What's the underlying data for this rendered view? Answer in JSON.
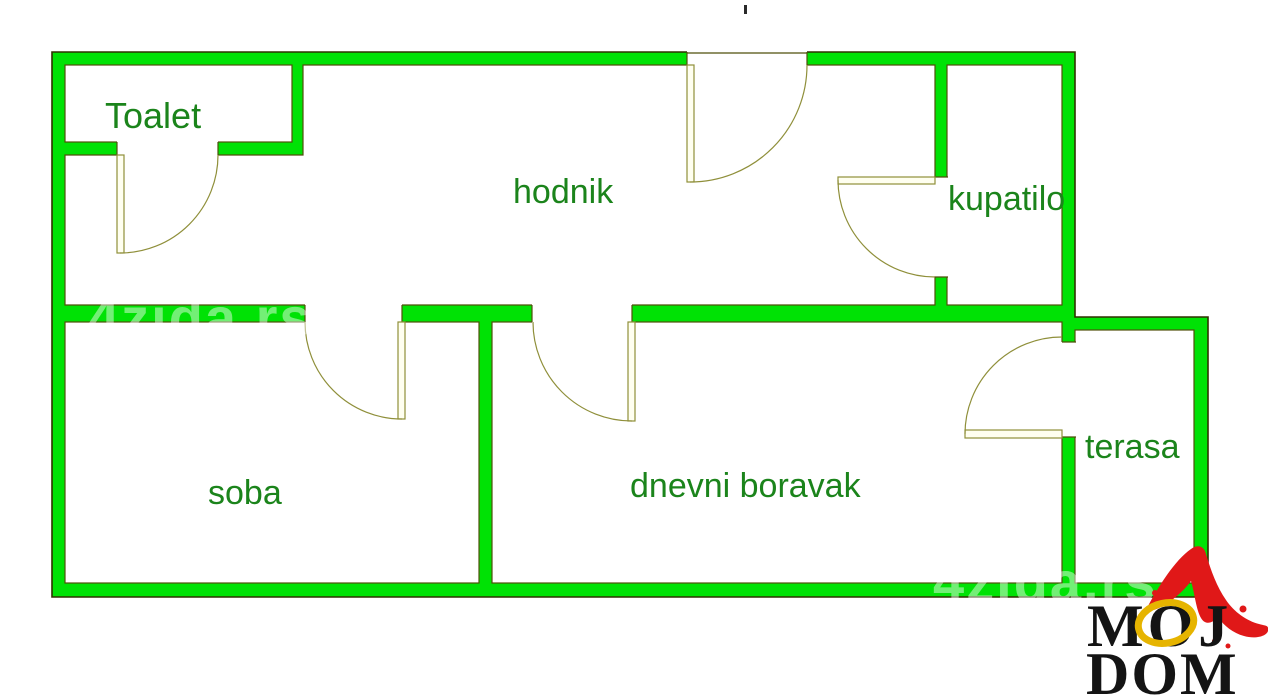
{
  "rooms": {
    "toalet": {
      "label": "Toalet"
    },
    "hodnik": {
      "label": "hodnik"
    },
    "kupatilo": {
      "label": "kupatilo"
    },
    "soba": {
      "label": "soba"
    },
    "dnevni_boravak": {
      "label": "dnevni boravak"
    },
    "terasa": {
      "label": "terasa"
    }
  },
  "watermark": {
    "text": "4zida.rs"
  },
  "logo": {
    "line1": "MOJ",
    "line2": "DOM"
  },
  "colors": {
    "wall-green": "#00e205",
    "outer-line": "#303000",
    "inner-line": "#4f4f0a",
    "arc-line": "#8f8f3a",
    "leaf-fill": "#fffff0",
    "label-green": "#1b841b",
    "logo-red": "#e01818",
    "logo-gold": "#e6b400",
    "logo-black": "#141414"
  }
}
